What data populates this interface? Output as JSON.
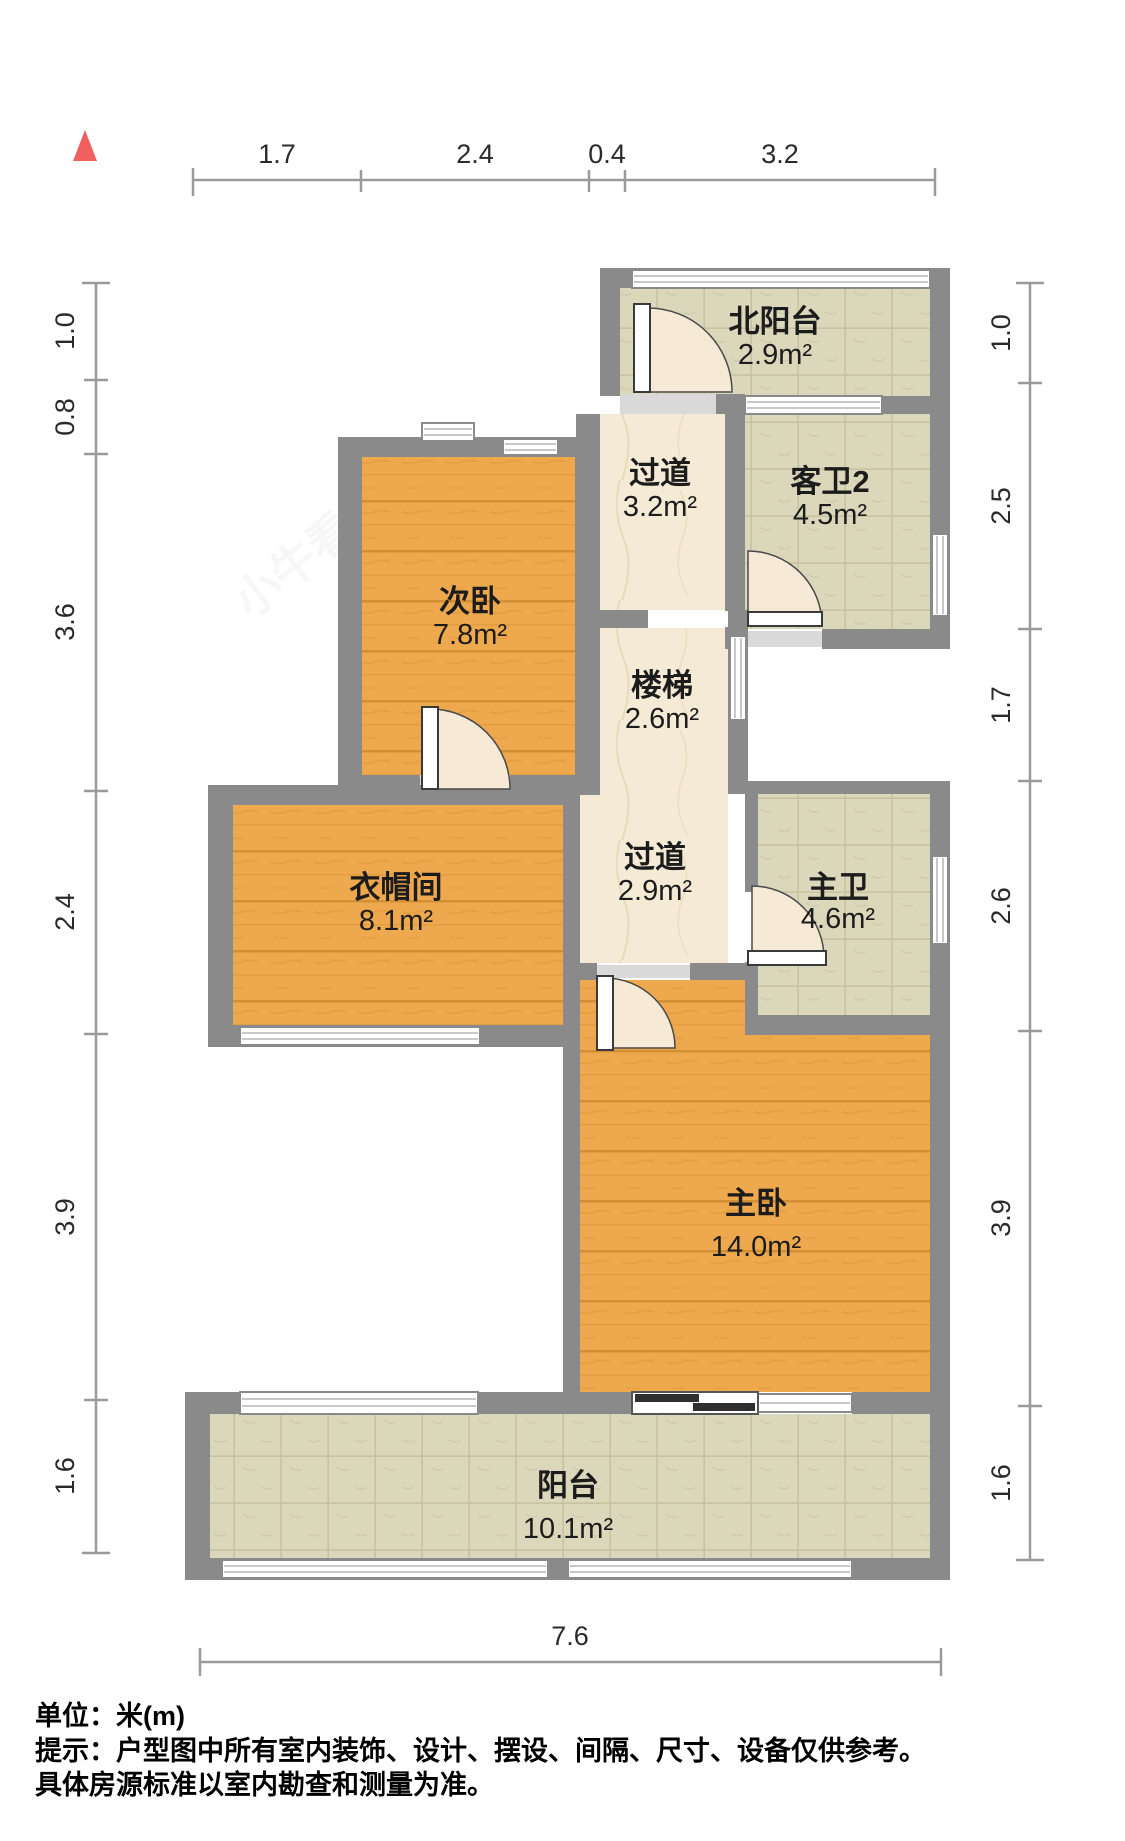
{
  "compass": {
    "icon": "north-arrow",
    "color": "#f15f5f"
  },
  "rooms": [
    {
      "id": "north_balcony",
      "name": "北阳台",
      "area": "2.9m²"
    },
    {
      "id": "corridor_top",
      "name": "过道",
      "area": "3.2m²"
    },
    {
      "id": "guest_bath_2",
      "name": "客卫2",
      "area": "4.5m²"
    },
    {
      "id": "second_bedroom",
      "name": "次卧",
      "area": "7.8m²"
    },
    {
      "id": "stairs",
      "name": "楼梯",
      "area": "2.6m²"
    },
    {
      "id": "cloakroom",
      "name": "衣帽间",
      "area": "8.1m²"
    },
    {
      "id": "corridor_mid",
      "name": "过道",
      "area": "2.9m²"
    },
    {
      "id": "master_bath",
      "name": "主卫",
      "area": "4.6m²"
    },
    {
      "id": "master_bedroom",
      "name": "主卧",
      "area": "14.0m²"
    },
    {
      "id": "balcony",
      "name": "阳台",
      "area": "10.1m²"
    }
  ],
  "dimensions": {
    "top": [
      "1.7",
      "2.4",
      "0.4",
      "3.2"
    ],
    "left": [
      "1.0",
      "0.8",
      "3.6",
      "2.4",
      "3.9",
      "1.6"
    ],
    "right": [
      "1.0",
      "2.5",
      "1.7",
      "2.6",
      "3.9",
      "1.6"
    ],
    "bottom": [
      "7.6"
    ]
  },
  "footer": {
    "unit_line": "单位：米(m)",
    "note_line1": "提示：户型图中所有室内装饰、设计、摆设、间隔、尺寸、设备仅供参考。",
    "note_line2": "具体房源标准以室内勘查和测量为准。"
  },
  "watermark": {
    "text": "小牛看房"
  },
  "colors": {
    "wall": "#8a8a8a",
    "wood_floor": "#eea84e",
    "wood_seam": "#d28f33",
    "marble_floor": "#f4ead6",
    "tile_floor": "#dbd7ba",
    "tile_grid": "#c7c2a1",
    "door_swing": "#f6ead7",
    "window_fill": "#ffffff",
    "sliding_door": "#2f2f2f",
    "north_arrow": "#f15f5f"
  }
}
